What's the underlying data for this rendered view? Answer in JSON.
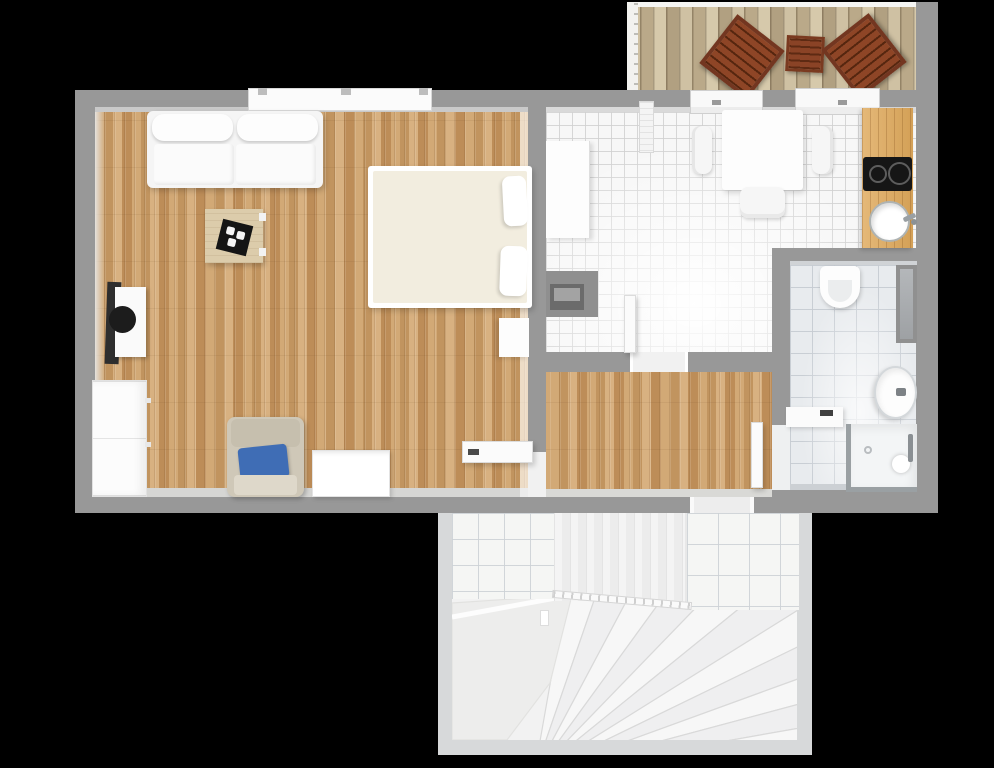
{
  "scene": {
    "type": "apartment-floor-plan-top-view",
    "rooms": [
      {
        "name": "living-room",
        "floor": "wood-parquet",
        "furniture": [
          "sofa",
          "double-bed",
          "coffee-table",
          "black-tray",
          "loudspeaker",
          "tall-cabinet",
          "armchair-with-blue-pillow",
          "storage-chest",
          "open-door-leaf",
          "wall-shelf"
        ]
      },
      {
        "name": "kitchen-dining",
        "floor": "white-tile",
        "furniture": [
          "sideboard",
          "radiator",
          "dining-table",
          "dining-chair-left",
          "dining-chair-right",
          "dining-chair-bottom",
          "kitchen-counter",
          "cooktop-2-burners",
          "round-sink",
          "wall-niche"
        ]
      },
      {
        "name": "balcony",
        "floor": "wood-decking",
        "furniture": [
          "deck-chair-left",
          "deck-side-table",
          "deck-chair-right",
          "railing"
        ]
      },
      {
        "name": "hallway",
        "floor": "wood-parquet",
        "furniture": []
      },
      {
        "name": "bathroom",
        "floor": "gray-tile",
        "furniture": [
          "wall-hung-toilet",
          "oval-washbasin",
          "shower-enclosure",
          "bench-shelf",
          "open-door-leaf",
          "duct-niche"
        ]
      },
      {
        "name": "stairwell",
        "floor": "white",
        "furniture": [
          "winder-staircase",
          "railing-balustrade",
          "tiled-wall-left",
          "tiled-wall-right"
        ]
      }
    ],
    "counts": {
      "deck_chairs": 2,
      "deck_tables": 1,
      "dining_chairs": 3,
      "sofas": 1,
      "beds": 1,
      "armchairs": 1
    }
  },
  "palette": {
    "background": "#000000",
    "wall": "#989898",
    "wall_light": "#d7d9da",
    "wood_floor": "#cda26c",
    "kitchen_tile": "#f7f7f7",
    "bath_tile": "#e8ebee",
    "deck_wood": "#c9ba9b",
    "outdoor_furniture_brown": "#7c3a1f",
    "accent_pillow_blue": "#3f6db5",
    "appliance_black": "#161616",
    "fixture_white": "#fbfbfb"
  }
}
